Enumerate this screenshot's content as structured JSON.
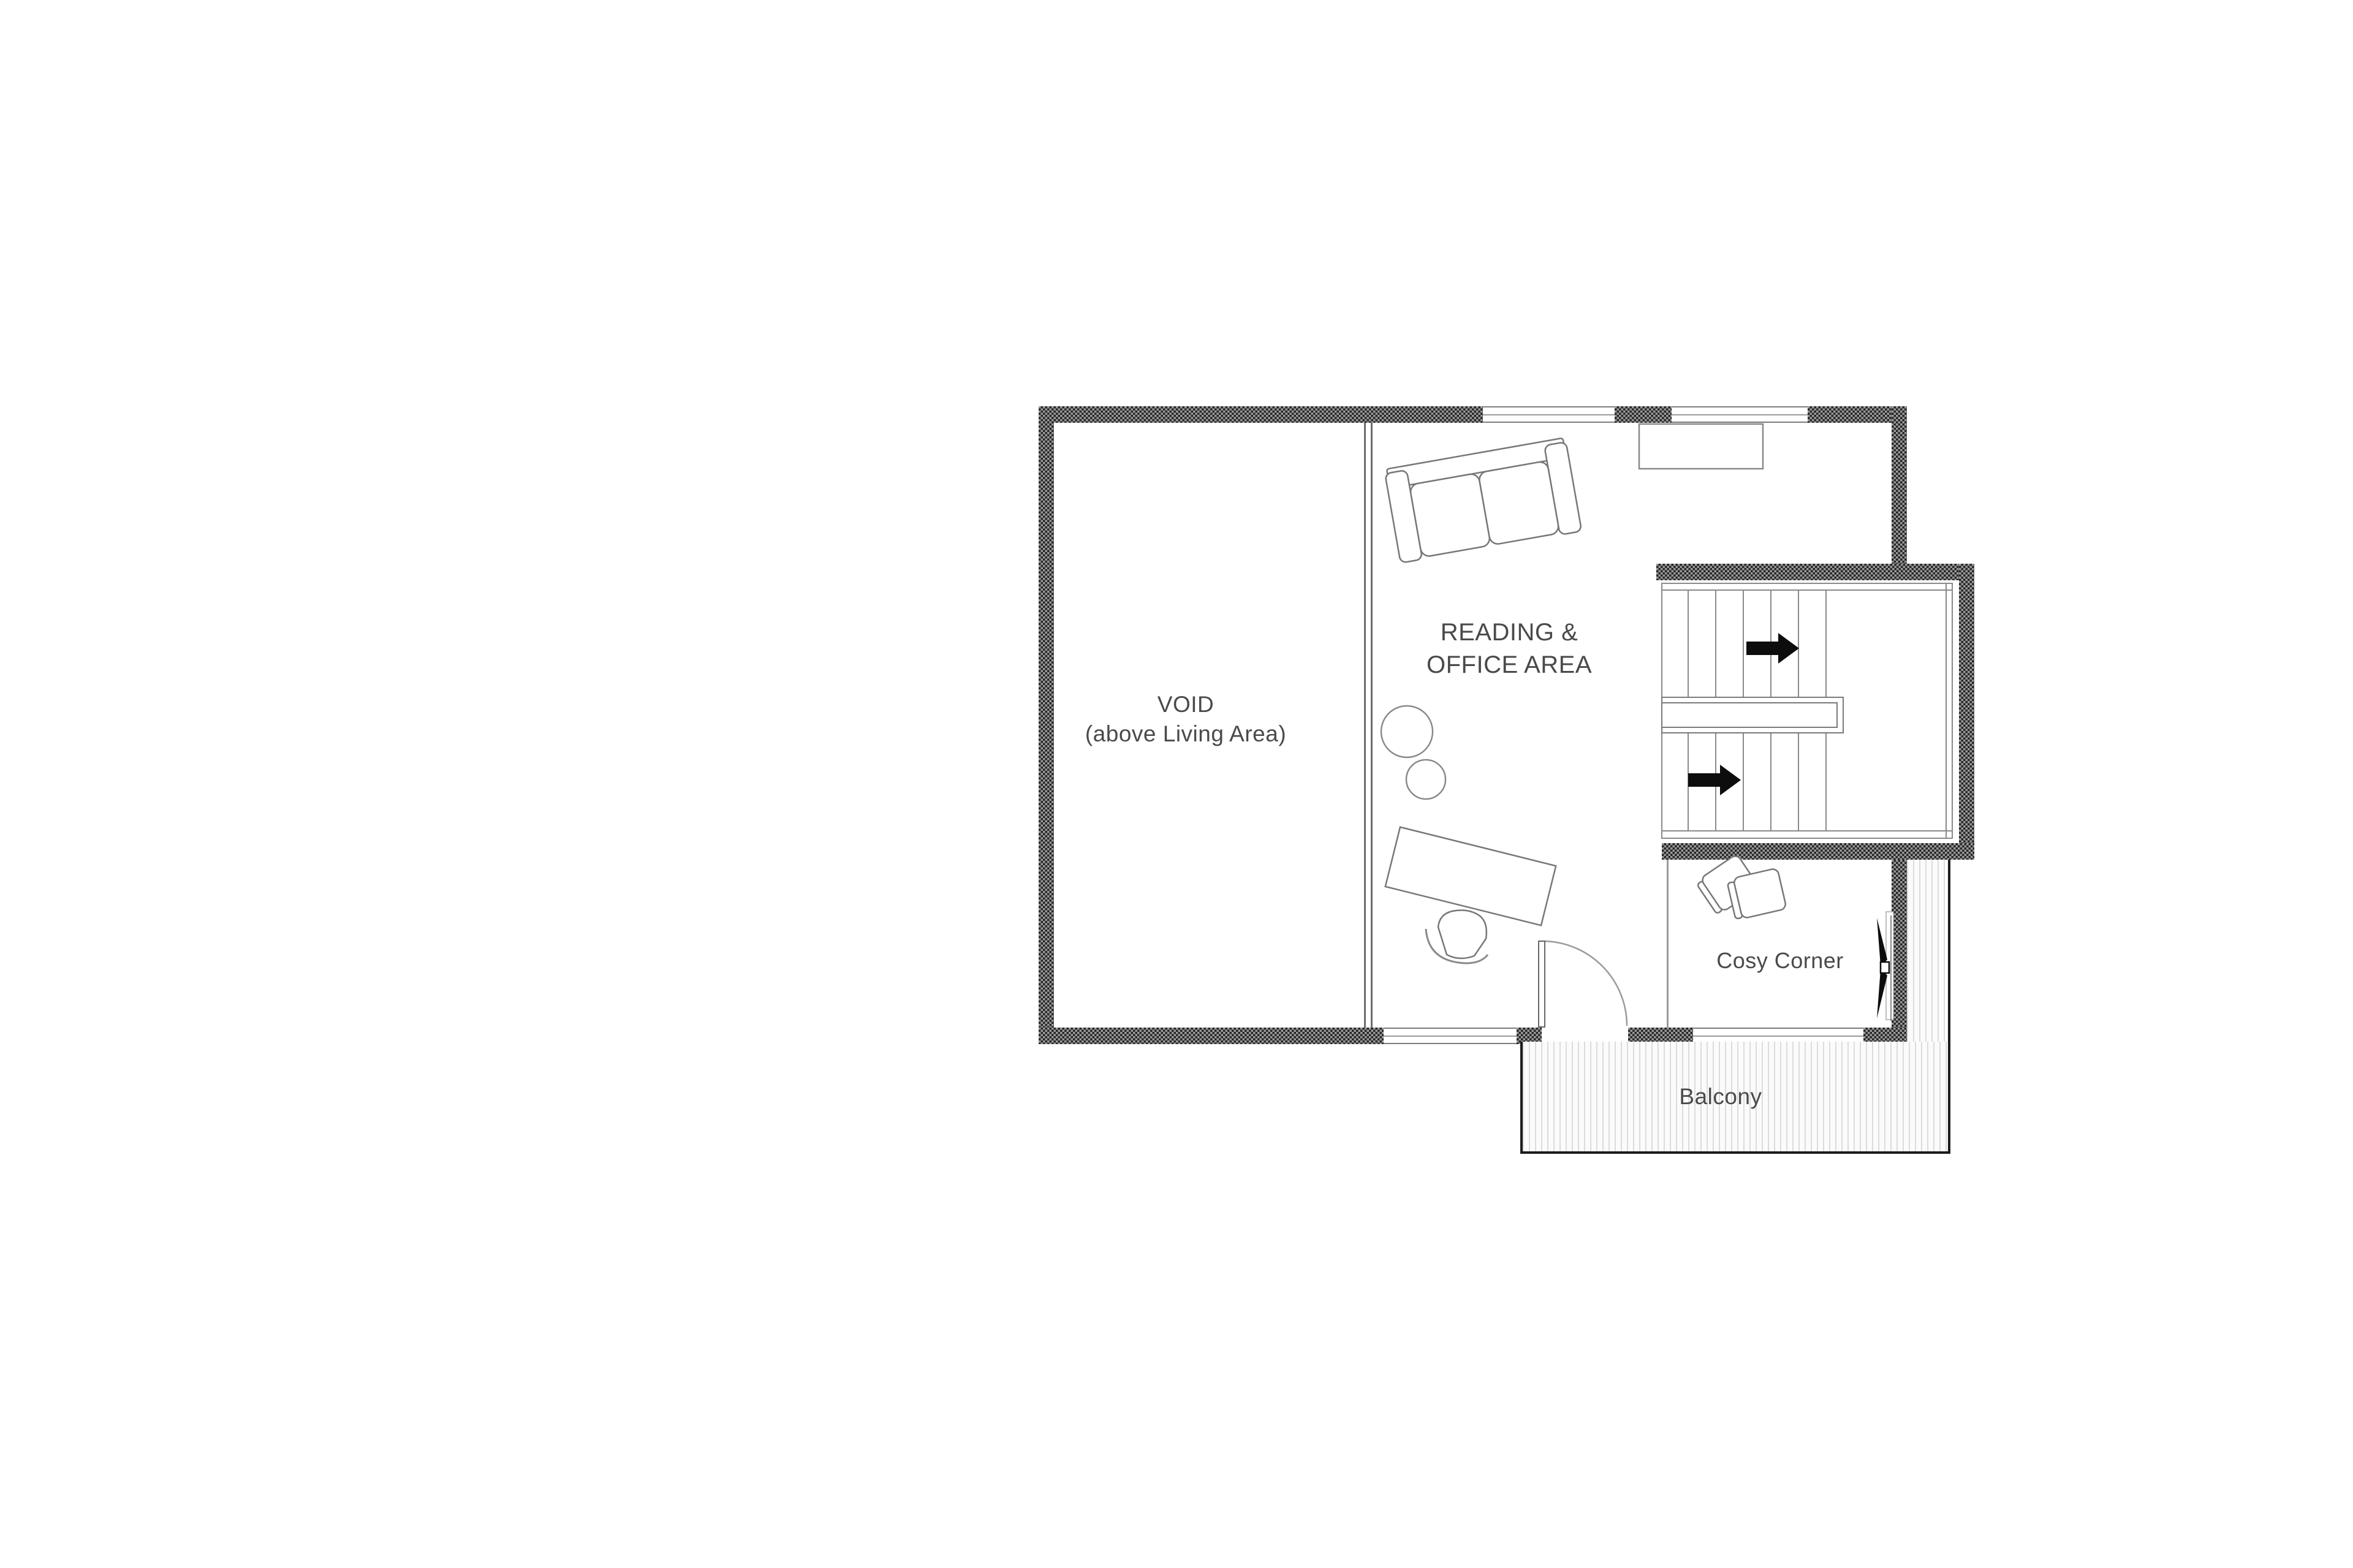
{
  "rooms": {
    "void": {
      "line1": "VOID",
      "line2": "(above Living Area)"
    },
    "reading_office": {
      "line1": "READING &",
      "line2": "OFFICE AREA"
    },
    "cosy_corner": {
      "label": "Cosy Corner"
    },
    "balcony": {
      "label": "Balcony"
    }
  },
  "icons": {
    "stair_arrow_upper": "arrow-right",
    "stair_arrow_lower": "arrow-right"
  },
  "colors": {
    "background": "#ffffff",
    "wall_hatch_dark": "#262626",
    "wall_hatch_light": "#9a9a9a",
    "drawing_line_grey": "#8a8a8a",
    "furniture_line_grey": "#777777",
    "text_grey": "#4a4a4a",
    "balcony_edge_black": "#1c1c1c",
    "arrow_black": "#0d0d0d"
  }
}
